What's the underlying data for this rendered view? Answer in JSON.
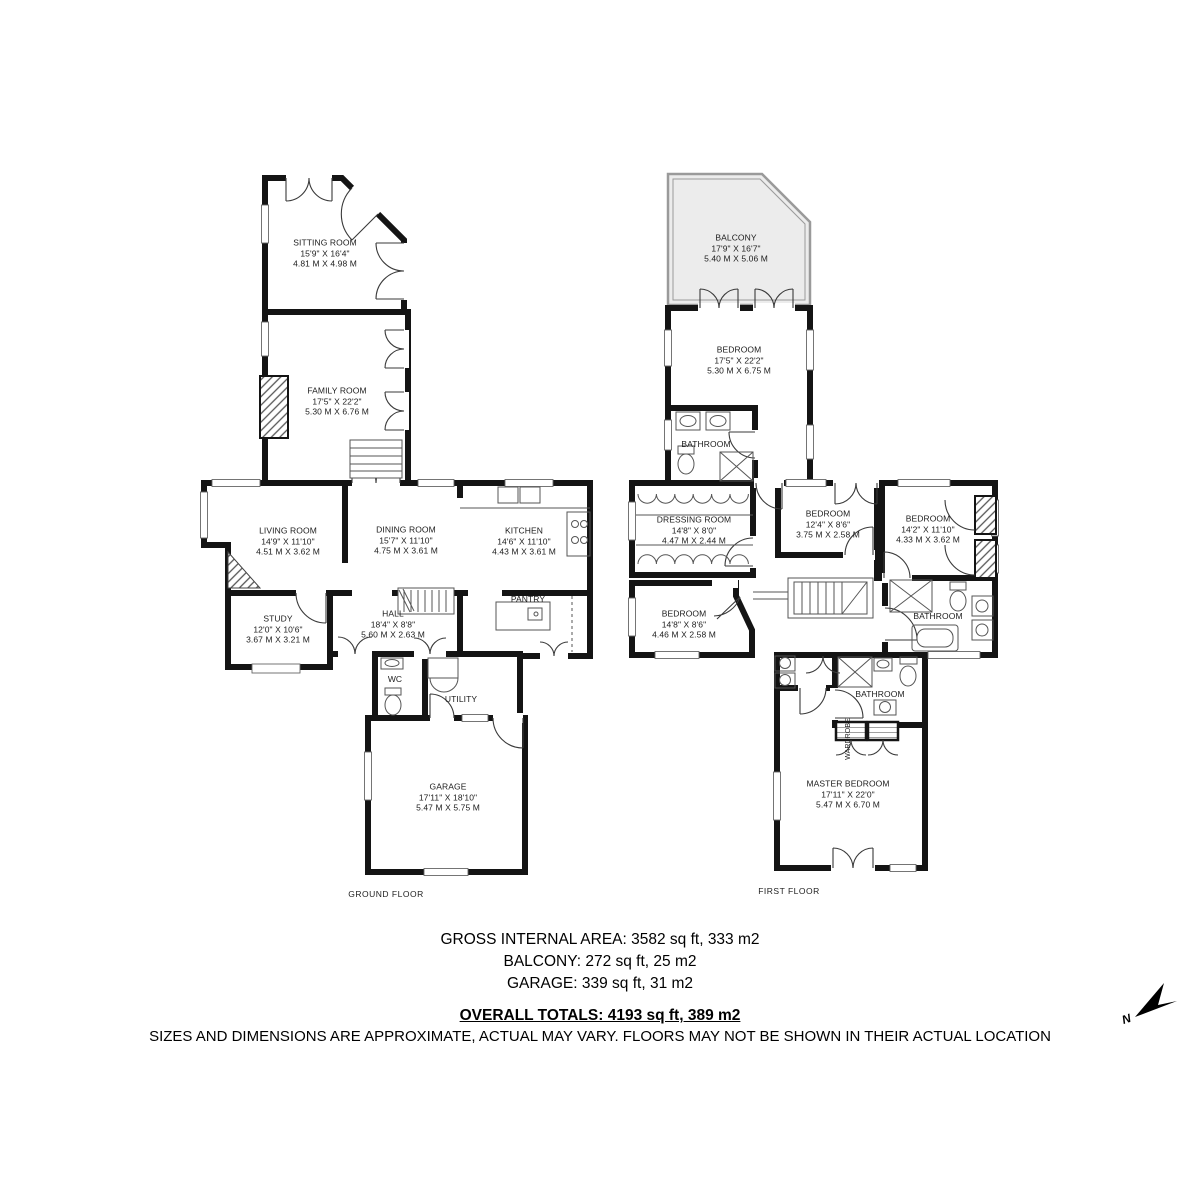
{
  "ground": {
    "floor_label": "GROUND FLOOR",
    "rooms": {
      "sitting": {
        "name": "SITTING ROOM",
        "imperial": "15'9\" X 16'4\"",
        "metric": "4.81 M X 4.98 M"
      },
      "family": {
        "name": "FAMILY ROOM",
        "imperial": "17'5\" X 22'2\"",
        "metric": "5.30 M X 6.76 M"
      },
      "living": {
        "name": "LIVING ROOM",
        "imperial": "14'9\" X 11'10\"",
        "metric": "4.51 M X 3.62 M"
      },
      "dining": {
        "name": "DINING ROOM",
        "imperial": "15'7\" X 11'10\"",
        "metric": "4.75 M X 3.61 M"
      },
      "kitchen": {
        "name": "KITCHEN",
        "imperial": "14'6\" X 11'10\"",
        "metric": "4.43 M X 3.61 M"
      },
      "study": {
        "name": "STUDY",
        "imperial": "12'0\" X 10'6\"",
        "metric": "3.67 M X 3.21 M"
      },
      "hall": {
        "name": "HALL",
        "imperial": "18'4\" X 8'8\"",
        "metric": "5.60 M X 2.63 M"
      },
      "pantry": {
        "name": "PANTRY"
      },
      "wc": {
        "name": "WC"
      },
      "utility": {
        "name": "UTILITY"
      },
      "garage": {
        "name": "GARAGE",
        "imperial": "17'11\" X 18'10\"",
        "metric": "5.47 M X 5.75 M"
      }
    }
  },
  "first": {
    "floor_label": "FIRST FLOOR",
    "rooms": {
      "balcony": {
        "name": "BALCONY",
        "imperial": "17'9\" X 16'7\"",
        "metric": "5.40 M X 5.06 M"
      },
      "bedroom1": {
        "name": "BEDROOM",
        "imperial": "17'5\" X 22'2\"",
        "metric": "5.30 M X 6.75 M"
      },
      "bathroom_ensuite": {
        "name": "BATHROOM"
      },
      "dressing": {
        "name": "DRESSING ROOM",
        "imperial": "14'8\" X 8'0\"",
        "metric": "4.47 M X 2.44 M"
      },
      "bedroom2": {
        "name": "BEDROOM",
        "imperial": "12'4\" X 8'6\"",
        "metric": "3.75 M X 2.58 M"
      },
      "bedroom3": {
        "name": "BEDROOM",
        "imperial": "14'2\" X 11'10\"",
        "metric": "4.33 M X 3.62 M"
      },
      "bedroom4": {
        "name": "BEDROOM",
        "imperial": "14'8\" X 8'6\"",
        "metric": "4.46 M X 2.58 M"
      },
      "bathroom_main": {
        "name": "BATHROOM"
      },
      "bathroom_master": {
        "name": "BATHROOM"
      },
      "wardrobe": {
        "name": "WARDROBE"
      },
      "master": {
        "name": "MASTER BEDROOM",
        "imperial": "17'11\" X 22'0\"",
        "metric": "5.47 M X 6.70 M"
      }
    }
  },
  "footer": {
    "gross": "GROSS INTERNAL AREA: 3582 sq ft, 333 m2",
    "balcony": "BALCONY: 272 sq ft, 25 m2",
    "garage": "GARAGE: 339 sq ft, 31 m2",
    "totals": "OVERALL TOTALS: 4193 sq ft, 389 m2",
    "disclaimer": "SIZES AND DIMENSIONS ARE APPROXIMATE, ACTUAL MAY VARY.  FLOORS MAY NOT BE SHOWN IN THEIR ACTUAL LOCATION"
  },
  "compass": {
    "label": "N"
  }
}
